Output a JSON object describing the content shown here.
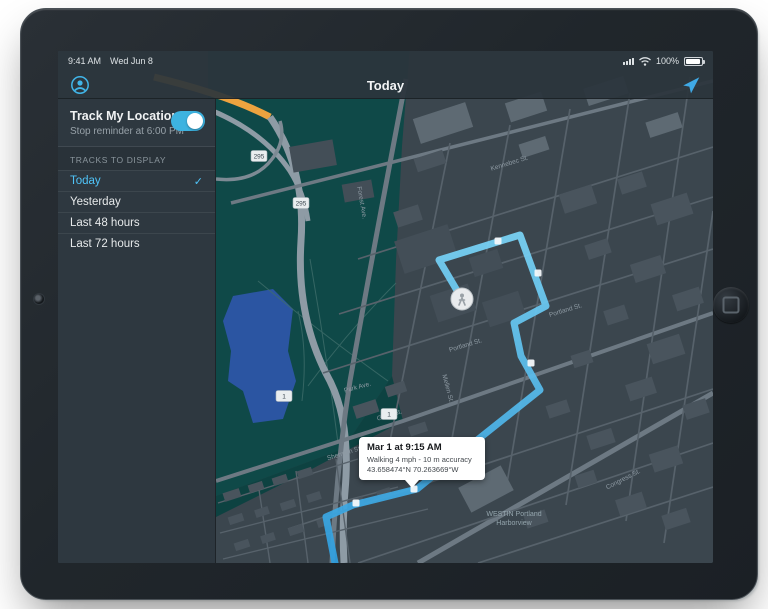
{
  "status_bar": {
    "time": "9:41 AM",
    "date": "Wed Jun 8",
    "battery_percent": "100%"
  },
  "nav_bar": {
    "title": "Today"
  },
  "sidebar": {
    "track": {
      "title": "Track My Location",
      "subtitle": "Stop reminder at 6:00 PM",
      "enabled": true
    },
    "section_label": "TRACKS TO DISPLAY",
    "checkmark": "✓",
    "items": [
      {
        "label": "Today",
        "selected": true
      },
      {
        "label": "Yesterday",
        "selected": false
      },
      {
        "label": "Last 48 hours",
        "selected": false
      },
      {
        "label": "Last 72 hours",
        "selected": false
      }
    ]
  },
  "map": {
    "callout": {
      "title": "Mar 1 at 9:15 AM",
      "detail": "Walking 4 mph - 10 m accuracy",
      "coordinates": "43.658474°N  70.263669°W"
    },
    "poi": {
      "line1": "WESTIN Portland",
      "line2": "Harborview"
    },
    "route": {
      "color_top": "#7ad5f8",
      "color_bottom": "#2f9fe0",
      "points": [
        [
          404,
          248
        ],
        [
          381,
          209
        ],
        [
          462,
          184
        ],
        [
          488,
          255
        ],
        [
          456,
          272
        ],
        [
          463,
          305
        ],
        [
          482,
          339
        ],
        [
          413,
          394
        ],
        [
          359,
          438
        ],
        [
          295,
          454
        ],
        [
          268,
          466
        ],
        [
          277,
          512
        ]
      ],
      "waypoints": [
        [
          440,
          190
        ],
        [
          480,
          222
        ],
        [
          473,
          312
        ],
        [
          356,
          438
        ],
        [
          298,
          452
        ]
      ]
    },
    "marker": {
      "x": 404,
      "y": 248
    },
    "street_labels": [
      {
        "text": "Portland St.",
        "x": 408,
        "y": 296,
        "angle": -17
      },
      {
        "text": "Portland St.",
        "x": 508,
        "y": 261,
        "angle": -17
      },
      {
        "text": "Sherman St.",
        "x": 287,
        "y": 404,
        "angle": -17
      },
      {
        "text": "Grant St.",
        "x": 332,
        "y": 366,
        "angle": -17
      },
      {
        "text": "Mellen St.",
        "x": 388,
        "y": 338,
        "angle": 75
      },
      {
        "text": "Park Ave.",
        "x": 300,
        "y": 338,
        "angle": -15
      },
      {
        "text": "Forest Ave.",
        "x": 302,
        "y": 152,
        "angle": 80
      },
      {
        "text": "Kennebec St.",
        "x": 452,
        "y": 114,
        "angle": -17
      },
      {
        "text": "Congress St.",
        "x": 566,
        "y": 430,
        "angle": -27
      }
    ],
    "shields": [
      {
        "text": "295",
        "x": 201,
        "y": 105
      },
      {
        "text": "295",
        "x": 243,
        "y": 152
      },
      {
        "text": "1",
        "x": 226,
        "y": 345
      },
      {
        "text": "1",
        "x": 331,
        "y": 363
      }
    ]
  }
}
